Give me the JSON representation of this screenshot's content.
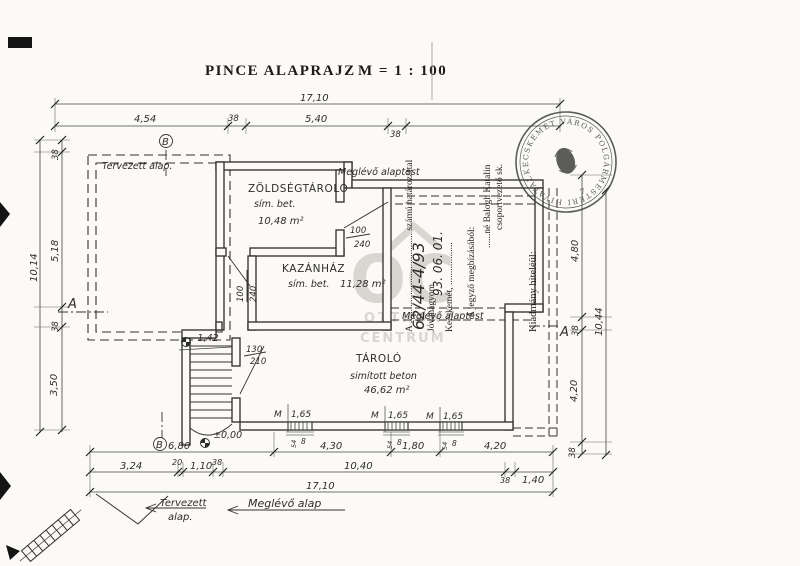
{
  "page": {
    "title": "PINCE ALAPRAJZ",
    "scale": "M = 1 : 100"
  },
  "rooms": {
    "vegetable_store": {
      "name": "ZÖLDSÉGTÁROLÓ",
      "finish": "sím. bet.",
      "area": "10,48 m²"
    },
    "boiler_room": {
      "name": "KAZÁNHÁZ",
      "finish": "sím. bet.",
      "area": "11,28 m²"
    },
    "storage": {
      "name": "TÁROLÓ",
      "finish": "simított beton",
      "area": "46,62 m²"
    }
  },
  "doors": {
    "d1": {
      "width": "100",
      "height": "240"
    },
    "d2": {
      "width": "100",
      "height": "240"
    },
    "d3": {
      "width": "130",
      "height": "210"
    }
  },
  "windows": {
    "mark": "M",
    "size": "1,65",
    "sill_a": "54",
    "sill_b": "8"
  },
  "levels": {
    "stair_landing": "-1,42",
    "entrance": "±0,00"
  },
  "dims": {
    "top_overall": "17,10",
    "top": [
      "4,54",
      "38",
      "5,40",
      "38"
    ],
    "left_overall": "10,14",
    "left": [
      "38",
      "5,18",
      "38",
      "3,50"
    ],
    "right_overall": "10,44",
    "right": [
      "4,80",
      "38",
      "4,20",
      "38"
    ],
    "bottom1": [
      "6,80",
      "4,30",
      "1,80",
      "4,20"
    ],
    "bottom2": [
      "3,24",
      "20",
      "1,10",
      "38",
      "10,40",
      "38",
      "1,40"
    ],
    "bottom_overall": "17,10"
  },
  "sections": {
    "a": "A",
    "b": "B"
  },
  "annotations": {
    "planned_foundation": "Tervezett alap.",
    "existing_foundation_top": "Meglévő alaptest",
    "existing_foundation_mid": "Meglévő alaptest",
    "legend_planned_1": "Tervezett",
    "legend_planned_2": "alap.",
    "legend_existing": "Meglévő alap"
  },
  "permit": {
    "approval_line": "A ...................................... számú határozattal",
    "approval_number": "62/44-4/93",
    "approval_word": "Jóváhagyom.",
    "city_line": "Kecskemét, ..................",
    "date_hand": "93. 06. 01.",
    "authority_line": "A jegyző megbízásából:",
    "signatory_name": "......né Balogh Katalin",
    "signatory_title": "csoportvezető sk.",
    "certification": "Kiadmány hiteléül:",
    "stamp_ring_text": "KECSKEMÉT VÁROS POLGÁRMESTERI HIVATALA •",
    "stamp_number": "7"
  },
  "watermark": {
    "logo": "OC",
    "line1": "OTTHON",
    "line2": "CENTRUM"
  },
  "colors": {
    "ink": "#2b2b28",
    "paper": "#fbfaf6",
    "watermark": "#d8d6d0"
  }
}
